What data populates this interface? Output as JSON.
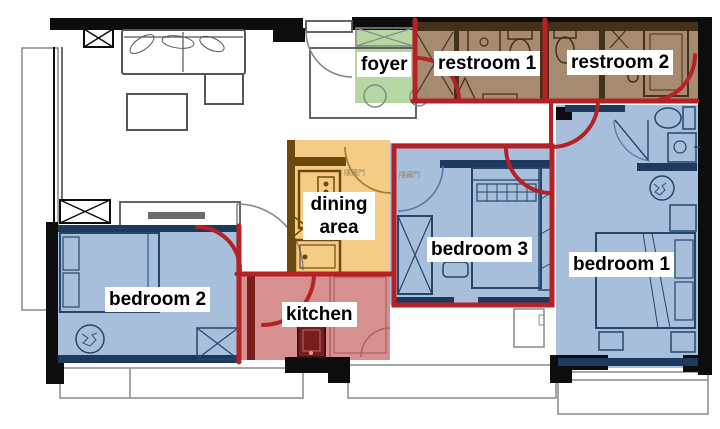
{
  "figure": {
    "type": "apartment floor plan with colored room overlays and red boundary annotations",
    "canvas": {
      "width": 720,
      "height": 429
    }
  },
  "rooms": [
    {
      "id": "foyer",
      "label": "foyer",
      "overlay_color": "#b5d7a2"
    },
    {
      "id": "restroom-1",
      "label": "restroom 1",
      "overlay_color": "#a78b70"
    },
    {
      "id": "restroom-2",
      "label": "restroom 2",
      "overlay_color": "#a78b70"
    },
    {
      "id": "dining-area",
      "label": "dining area",
      "overlay_color": "#f5cc85"
    },
    {
      "id": "kitchen",
      "label": "kitchen",
      "overlay_color": "#d69090"
    },
    {
      "id": "bedroom-1",
      "label": "bedroom 1",
      "overlay_color": "#a8bfdc"
    },
    {
      "id": "bedroom-2",
      "label": "bedroom 2",
      "overlay_color": "#a8bfdc"
    },
    {
      "id": "bedroom-3",
      "label": "bedroom 3",
      "overlay_color": "#a8bfdc"
    }
  ],
  "annotations": {
    "boundary_color": "#b62125",
    "hidden_door_label": "隱藏門"
  },
  "colors": {
    "wall": "#0d0d0d",
    "line": "#555555",
    "green": "#b5d7a2",
    "brown": "#a78b70",
    "brown_dark": "#45301a",
    "brown_door": "#8a6b4e",
    "cream": "#e8e0d4",
    "orange": "#f5cc85",
    "orange_dark": "#6b4a10",
    "orange_pale": "#f3ddb0",
    "red_room": "#d69090",
    "red_room_dark": "#7a1d1d",
    "blue": "#a8bfdc",
    "blue_light": "#bccde4",
    "blue_pale": "#dce6f2",
    "navy": "#24466b",
    "navy_dark": "#1d3a5c",
    "annotation": "#b62125",
    "label_bg": "#ffffff",
    "label_text": "#000000",
    "cjk": "#9a8450"
  }
}
